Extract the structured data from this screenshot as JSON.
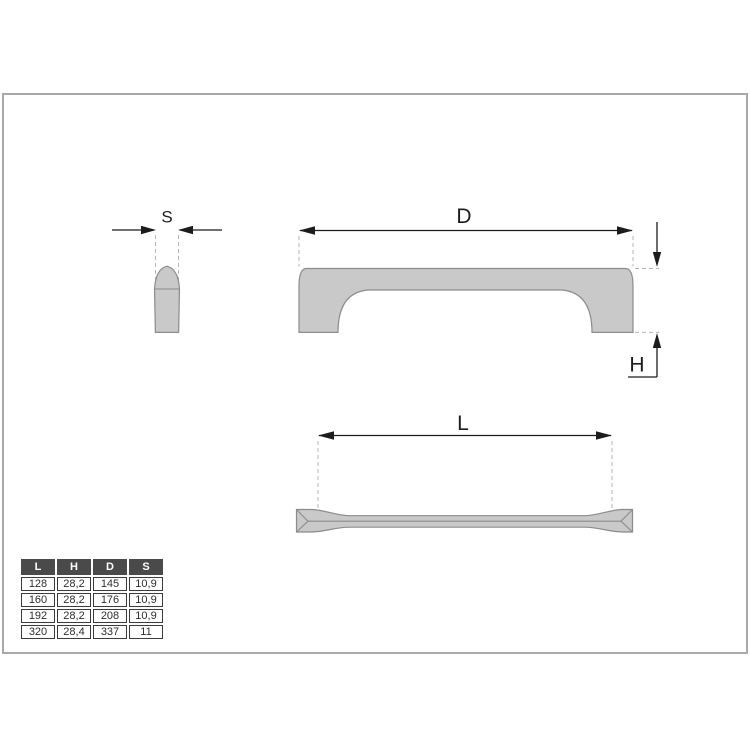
{
  "drawing": {
    "labels": {
      "s": "S",
      "d": "D",
      "h": "H",
      "l": "L"
    },
    "views": {
      "side_profile": "handle-side-profile",
      "front": "handle-front-view",
      "top": "handle-top-view"
    }
  },
  "dim_table": {
    "headers": [
      "L",
      "H",
      "D",
      "S"
    ],
    "rows": [
      [
        "128",
        "28,2",
        "145",
        "10,9"
      ],
      [
        "160",
        "28,2",
        "176",
        "10,9"
      ],
      [
        "192",
        "28,2",
        "208",
        "10,9"
      ],
      [
        "320",
        "28,4",
        "337",
        "11"
      ]
    ]
  },
  "colors": {
    "part_fill": "#c9c9c9",
    "part_stroke": "#8c8c8c",
    "dimension_ink": "#1c1c1c",
    "extension_dash": "#b5b5b5",
    "frame_border": "#a9a9a9",
    "table_header_bg": "#4a4a4a",
    "table_header_text": "#ffffff"
  }
}
